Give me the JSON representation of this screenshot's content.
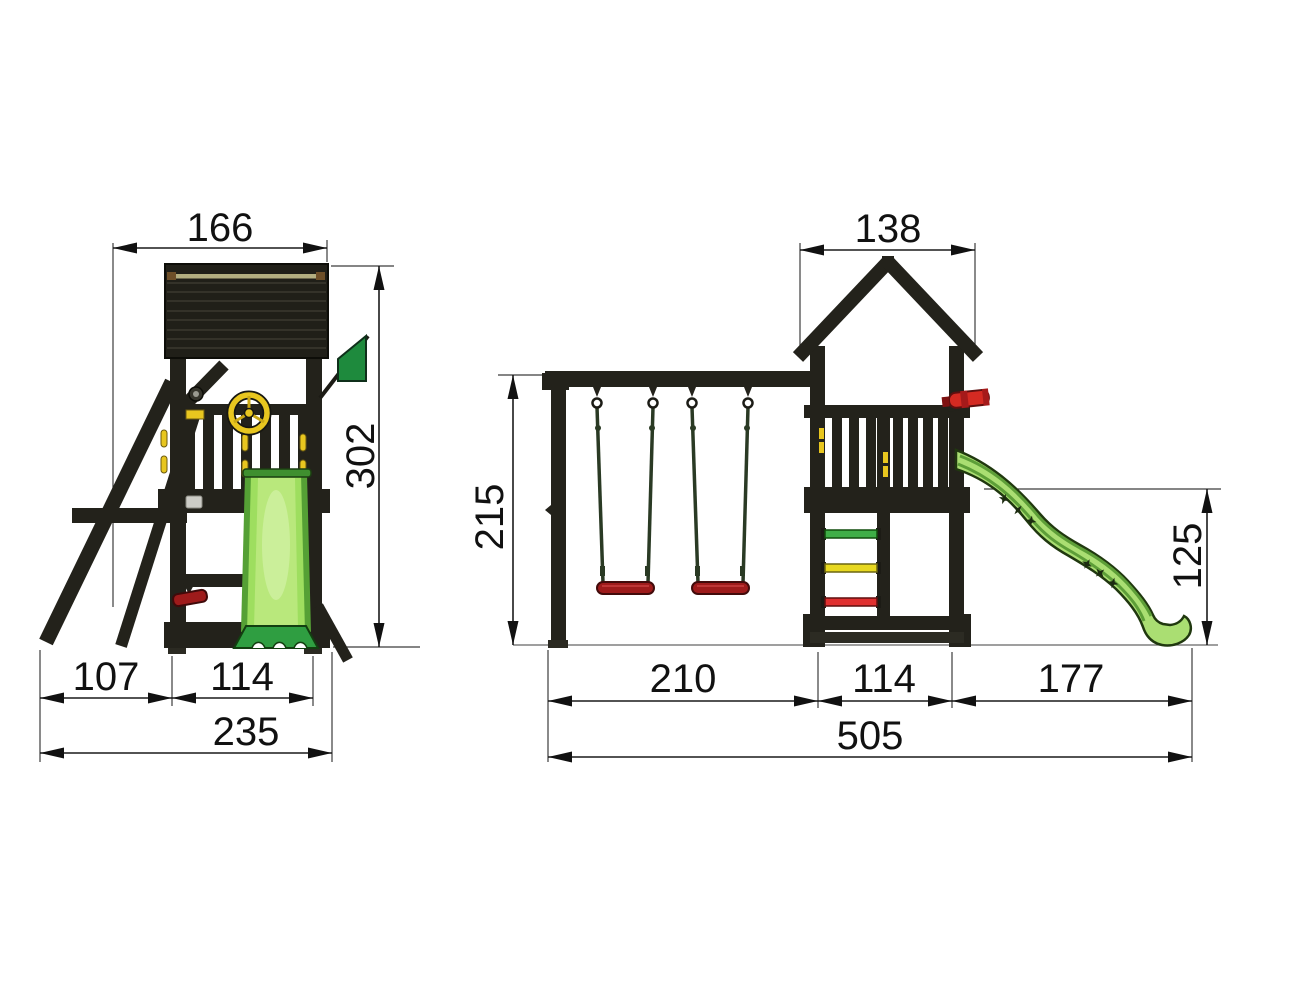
{
  "side_view": {
    "roof_width": "166",
    "total_height": "302",
    "front_offset": "107",
    "base_depth": "114",
    "total_depth": "235"
  },
  "front_view": {
    "roof_width": "138",
    "swing_height": "215",
    "slide_height": "125",
    "swing_span": "210",
    "base_width": "114",
    "slide_span": "177",
    "total_width": "505"
  },
  "colors": {
    "structure": "#23221b",
    "roof_trim_tan": "#b3ae80",
    "flag_green": "#1e8a3d",
    "slide_green": "#9ede5f",
    "slide_center_green": "#b9e87c",
    "slide_front_green": "#aade72",
    "slide_base_green": "#2f9e41",
    "slide_rail_green": "#55a035",
    "seat_red": "#9e1b1b",
    "telescope_red": "#d42a22",
    "accent_yellow": "#e8c61f",
    "rung_green": "#3fae47",
    "rung_yellow": "#e8d820",
    "rung_red": "#e03030"
  }
}
